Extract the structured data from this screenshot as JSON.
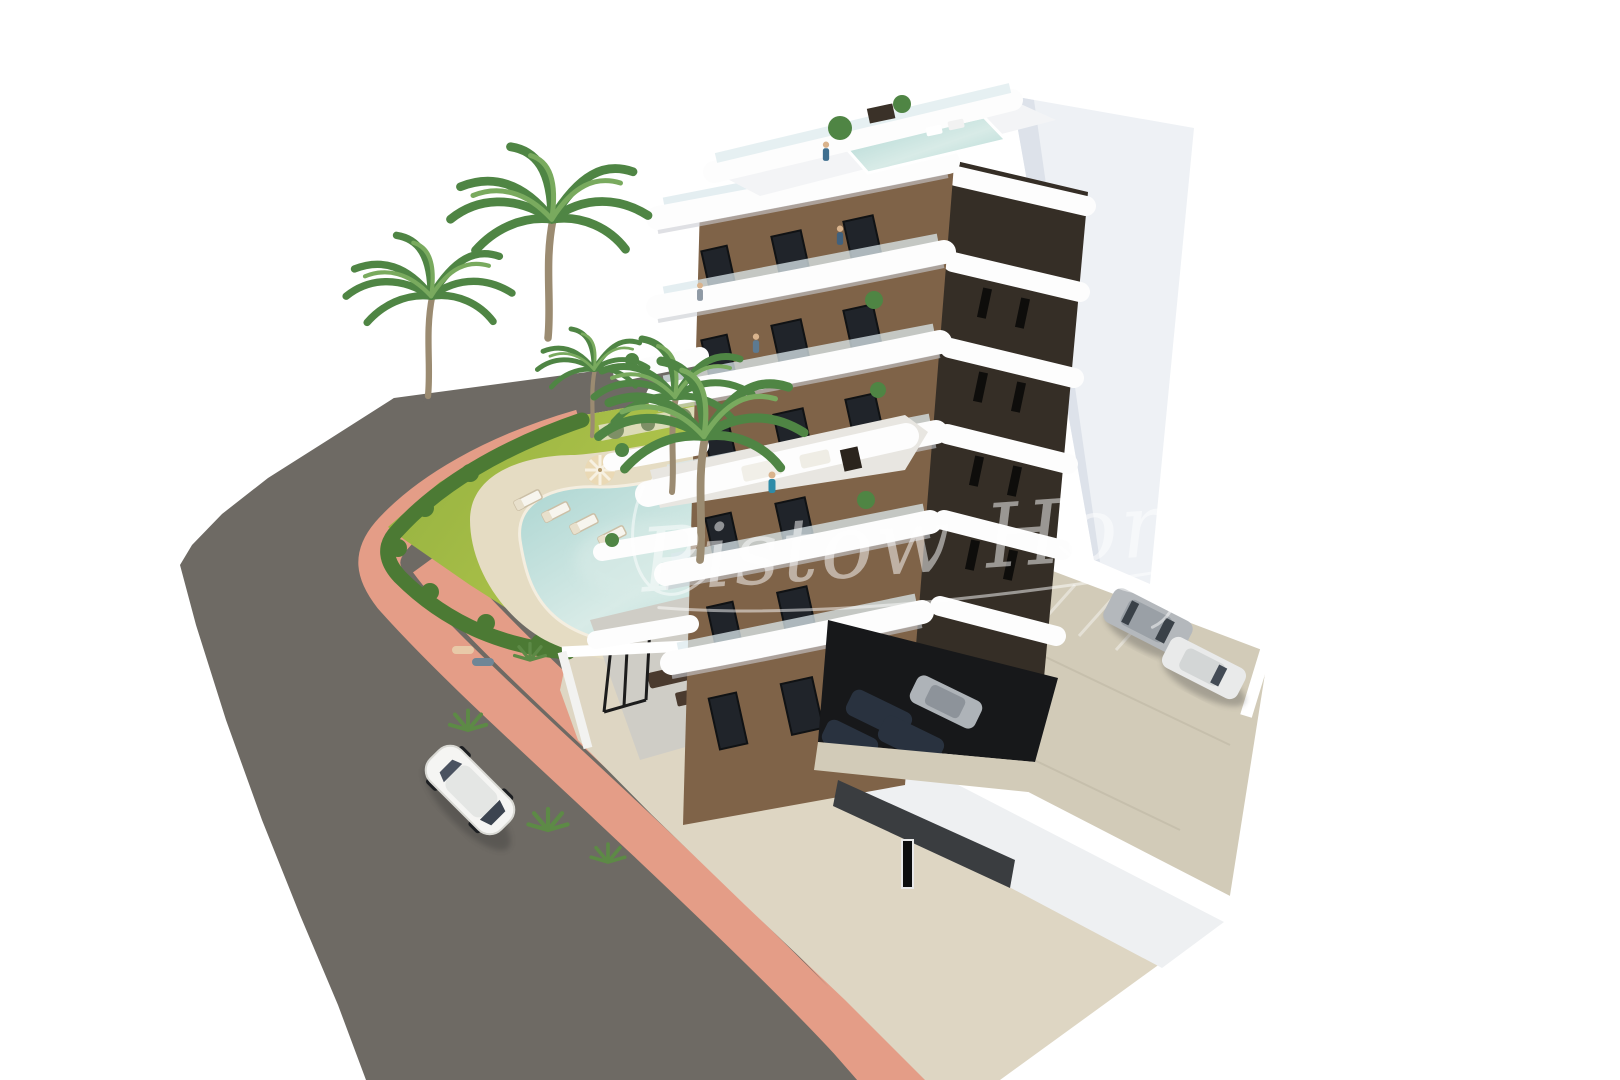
{
  "image": {
    "kind": "3d-architectural-render",
    "title": "Aerial render of a modern white apartment tower with pool garden, road and parking",
    "background": "#ffffff"
  },
  "watermark": {
    "text": "Pistow Honig",
    "style": "semi-transparent handwritten signature",
    "opacity": 0.5
  },
  "palette": {
    "background": "#ffffff",
    "asphalt": "#6e6a64",
    "sidewalk_pink": "#e49d87",
    "apron_concrete": "#ded6c3",
    "lawn_a": "#8fae3e",
    "lawn_b": "#ccd656",
    "hedge": "#4c7a34",
    "shrub_gray": "#7e8f66",
    "gravel": "#e9e3d3",
    "palm_frond": "#4f8544",
    "palm_frond_light": "#79aa5e",
    "palm_trunk": "#9b8b71",
    "pool_deck": "#e5dcc3",
    "pool_water": "#a9d4d0",
    "pool_water_light": "#d8ebe7",
    "building_white": "#fdfdfd",
    "roof_deck": "#f3f4f6",
    "band_shadow": "#c9ccd2",
    "glass": "#dce9ed",
    "facade_brown": "#7f6348",
    "facade_dark": "#352e26",
    "window_dark": "#20242a",
    "window_slit": "#0e0d0b",
    "pylon_white": "#eef1f5",
    "pylon_shade": "#dde2ea",
    "parking_floor": "#d2cbb8",
    "parking_wall": "#ffffff",
    "wall_face": "#eef0f2",
    "covered_dark": "#17181a",
    "ramp_wall": "#3a3d40",
    "terrace_floor": "#cfcdc6",
    "car_white": "#f5f5f3",
    "car_silver": "#b4b8bc",
    "car_dark": "#29323f",
    "furniture_brown": "#4a3a2e",
    "watermark_white": "#ffffff"
  },
  "scene": {
    "building": {
      "label": "apartment tower under construction render",
      "floors_visible": 7,
      "balcony_band_levels": 6,
      "left_facade": "brown panels with dark framed windows and curved white balconies",
      "right_facade": "dark brown recesses with white floor slabs and tall white side pylon",
      "rooftop": {
        "pool": 1,
        "planters": 2,
        "terraces": 2
      }
    },
    "garden": {
      "pool_shape": "freeform kidney",
      "sun_loungers": 6,
      "parasols": 2,
      "palm_trees": 5,
      "hedge_border": true,
      "ground_terrace_pergola": true
    },
    "parking": {
      "open_lot_cars": 2,
      "covered_cars": 4,
      "perimeter_walls": "white"
    },
    "road": {
      "surface": "dark asphalt",
      "sidewalk": "pink paved strip",
      "moving_cars": 1
    },
    "people_visible": 9
  }
}
